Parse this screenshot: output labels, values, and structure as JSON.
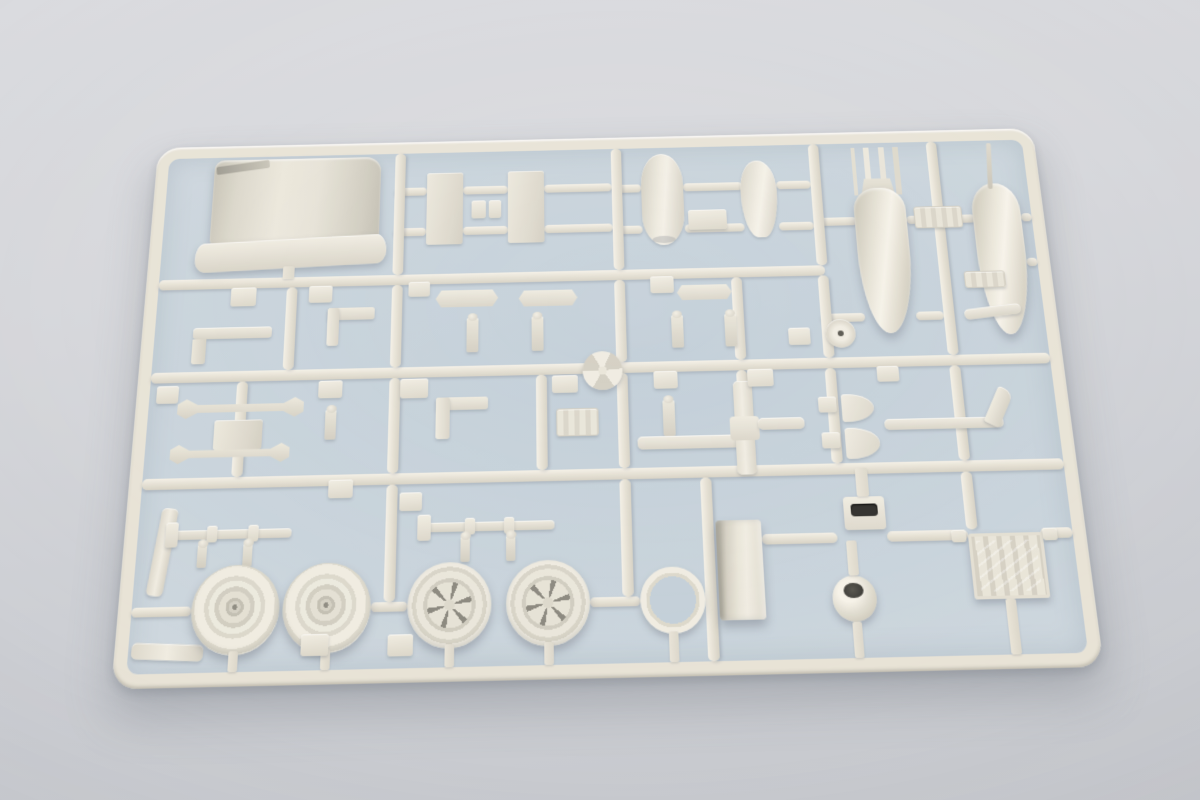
{
  "scene": {
    "description": "Photograph of a single off-white injection-molded plastic model kit sprue lying on a pale blue-gray surface, photographed at a slight angle",
    "background_color_top": "#dadbdf",
    "background_color_bottom": "#c6c8cd",
    "plastic_color": "#e8e3d6",
    "interior_tint": "#c6d2db",
    "shadow_color": "#5d626e"
  },
  "sprue": {
    "frame": {
      "width": 930,
      "height": 550,
      "thickness": 13,
      "corner_radius": 24
    },
    "runners": [
      {
        "x": 13,
        "y": 148,
        "w": 685,
        "h": 11
      },
      {
        "x": 13,
        "y": 246,
        "w": 904,
        "h": 11
      },
      {
        "x": 13,
        "y": 353,
        "w": 904,
        "h": 11
      },
      {
        "x": 253,
        "y": 52,
        "w": 34,
        "h": 9
      },
      {
        "x": 325,
        "y": 52,
        "w": 47,
        "h": 9
      },
      {
        "x": 410,
        "y": 52,
        "w": 71,
        "h": 9
      },
      {
        "x": 253,
        "y": 97,
        "w": 34,
        "h": 9
      },
      {
        "x": 325,
        "y": 97,
        "w": 47,
        "h": 9
      },
      {
        "x": 410,
        "y": 97,
        "w": 71,
        "h": 9
      },
      {
        "x": 481,
        "y": 54,
        "w": 31,
        "h": 9
      },
      {
        "x": 556,
        "y": 54,
        "w": 62,
        "h": 9
      },
      {
        "x": 654,
        "y": 54,
        "w": 36,
        "h": 9
      },
      {
        "x": 481,
        "y": 100,
        "w": 31,
        "h": 9
      },
      {
        "x": 556,
        "y": 100,
        "w": 62,
        "h": 9
      },
      {
        "x": 654,
        "y": 100,
        "w": 36,
        "h": 9
      },
      {
        "x": 690,
        "y": 96,
        "w": 45,
        "h": 9
      },
      {
        "x": 787,
        "y": 96,
        "w": 71,
        "h": 9
      },
      {
        "x": 906,
        "y": 96,
        "w": 11,
        "h": 9
      },
      {
        "x": 906,
        "y": 145,
        "w": 11,
        "h": 9
      },
      {
        "x": 690,
        "y": 200,
        "w": 45,
        "h": 9
      },
      {
        "x": 787,
        "y": 200,
        "w": 28,
        "h": 9
      },
      {
        "x": 617,
        "y": 420,
        "w": 73,
        "h": 10
      },
      {
        "x": 738,
        "y": 420,
        "w": 78,
        "h": 10
      },
      {
        "x": 886,
        "y": 420,
        "w": 31,
        "h": 10
      },
      {
        "x": 13,
        "y": 476,
        "w": 57,
        "h": 9
      },
      {
        "x": 241,
        "y": 476,
        "w": 35,
        "h": 9
      },
      {
        "x": 450,
        "y": 476,
        "w": 48,
        "h": 9
      },
      {
        "x": 253,
        "y": 13,
        "w": 11,
        "h": 135
      },
      {
        "x": 481,
        "y": 13,
        "w": 11,
        "h": 135
      },
      {
        "x": 690,
        "y": 13,
        "w": 11,
        "h": 135
      },
      {
        "x": 815,
        "y": 13,
        "w": 11,
        "h": 233
      },
      {
        "x": 145,
        "y": 159,
        "w": 11,
        "h": 87
      },
      {
        "x": 253,
        "y": 159,
        "w": 11,
        "h": 87
      },
      {
        "x": 481,
        "y": 159,
        "w": 11,
        "h": 87
      },
      {
        "x": 601,
        "y": 159,
        "w": 11,
        "h": 87
      },
      {
        "x": 690,
        "y": 159,
        "w": 11,
        "h": 87
      },
      {
        "x": 100,
        "y": 257,
        "w": 11,
        "h": 96
      },
      {
        "x": 253,
        "y": 257,
        "w": 11,
        "h": 96
      },
      {
        "x": 400,
        "y": 257,
        "w": 11,
        "h": 96
      },
      {
        "x": 481,
        "y": 257,
        "w": 11,
        "h": 96
      },
      {
        "x": 601,
        "y": 257,
        "w": 11,
        "h": 96
      },
      {
        "x": 690,
        "y": 257,
        "w": 11,
        "h": 96
      },
      {
        "x": 815,
        "y": 257,
        "w": 11,
        "h": 96
      },
      {
        "x": 253,
        "y": 364,
        "w": 11,
        "h": 112
      },
      {
        "x": 481,
        "y": 364,
        "w": 11,
        "h": 112
      },
      {
        "x": 560,
        "y": 364,
        "w": 11,
        "h": 173
      },
      {
        "x": 815,
        "y": 364,
        "w": 11,
        "h": 56
      }
    ],
    "parts": [
      {
        "n": "engine-cowling-panel",
        "s": "cowl-body",
        "x": 62,
        "y": 16,
        "w": 176,
        "h": 98
      },
      {
        "n": "cowling-lip",
        "s": "cowl-lip",
        "x": 48,
        "y": 106,
        "w": 198,
        "h": 32,
        "r": -2
      },
      {
        "n": "cowling-gate-stub",
        "s": "stub",
        "x": 140,
        "y": 136,
        "w": 12,
        "h": 14
      },
      {
        "n": "flat-panel-left",
        "s": "rect-panel",
        "x": 287,
        "y": 36,
        "w": 38,
        "h": 80
      },
      {
        "n": "flat-panel-right",
        "s": "rect-panel",
        "x": 372,
        "y": 36,
        "w": 38,
        "h": 80
      },
      {
        "n": "connector-block-a",
        "s": "sq",
        "x": 334,
        "y": 68,
        "w": 15,
        "h": 20
      },
      {
        "n": "connector-block-b",
        "s": "sq",
        "x": 352,
        "y": 68,
        "w": 13,
        "h": 20
      },
      {
        "n": "fuselage-spine",
        "s": "fuselage",
        "x": 512,
        "y": 20,
        "w": 44,
        "h": 102
      },
      {
        "n": "spine-block",
        "s": "sq",
        "x": 560,
        "y": 84,
        "w": 40,
        "h": 22
      },
      {
        "n": "tail-cone",
        "s": "teardrop",
        "x": 616,
        "y": 30,
        "w": 38,
        "h": 86
      },
      {
        "n": "bomb-tail-fins",
        "s": "fins4",
        "x": 735,
        "y": 18,
        "w": 50,
        "h": 54
      },
      {
        "n": "bomb-body",
        "s": "bomb",
        "x": 733,
        "y": 64,
        "w": 54,
        "h": 158
      },
      {
        "n": "drop-tank-body",
        "s": "tank",
        "x": 856,
        "y": 62,
        "w": 50,
        "h": 164
      },
      {
        "n": "pitot-antenna",
        "s": "antenna",
        "x": 877,
        "y": 16,
        "w": 5,
        "h": 52,
        "r": 4
      },
      {
        "n": "rack-bracket",
        "s": "bracket",
        "x": 795,
        "y": 86,
        "w": 50,
        "h": 24
      },
      {
        "n": "elbow-pipe-long",
        "s": "elbow",
        "x": 52,
        "y": 200,
        "w": 80,
        "h": 12
      },
      {
        "n": "fitting-sq-a",
        "s": "sq",
        "x": 88,
        "y": 158,
        "w": 26,
        "h": 20
      },
      {
        "n": "elbow-bracket",
        "s": "l-bracket",
        "x": 188,
        "y": 182,
        "w": 48,
        "h": 40
      },
      {
        "n": "fitting-sq-b",
        "s": "sq",
        "x": 168,
        "y": 158,
        "w": 24,
        "h": 18
      },
      {
        "n": "stabilizer-small-left",
        "s": "wing-sm",
        "x": 298,
        "y": 166,
        "w": 64,
        "h": 18
      },
      {
        "n": "fitting-sq-c",
        "s": "sq",
        "x": 270,
        "y": 156,
        "w": 22,
        "h": 16
      },
      {
        "n": "stabilizer-small-right",
        "s": "wing-sm",
        "x": 383,
        "y": 168,
        "w": 60,
        "h": 17
      },
      {
        "n": "knob-pin-a",
        "s": "pin",
        "x": 330,
        "y": 196,
        "w": 12,
        "h": 36
      },
      {
        "n": "knob-pin-b",
        "s": "pin",
        "x": 396,
        "y": 196,
        "w": 12,
        "h": 36
      },
      {
        "n": "fitting-sq-d",
        "s": "sq",
        "x": 518,
        "y": 156,
        "w": 24,
        "h": 18
      },
      {
        "n": "stabilizer-small-center",
        "s": "wing-sm",
        "x": 545,
        "y": 166,
        "w": 56,
        "h": 16
      },
      {
        "n": "knob-pin-c",
        "s": "pin",
        "x": 538,
        "y": 198,
        "w": 12,
        "h": 34
      },
      {
        "n": "knob-pin-d",
        "s": "pin",
        "x": 592,
        "y": 198,
        "w": 12,
        "h": 34
      },
      {
        "n": "wheel-hub-cap",
        "s": "screw-head",
        "x": 694,
        "y": 206,
        "w": 30,
        "h": 30
      },
      {
        "n": "fitting-sq-e",
        "s": "sq",
        "x": 656,
        "y": 214,
        "w": 22,
        "h": 18
      },
      {
        "n": "link-rod",
        "s": "arm-rod",
        "x": 836,
        "y": 196,
        "w": 58,
        "h": 11,
        "r": -6
      },
      {
        "n": "fitting-plate",
        "s": "bracket",
        "x": 840,
        "y": 158,
        "w": 42,
        "h": 18
      },
      {
        "n": "fitting-sq-f",
        "s": "sq",
        "x": 20,
        "y": 260,
        "w": 22,
        "h": 18
      },
      {
        "n": "tail-plane-upper",
        "s": "stab-wing",
        "x": 42,
        "y": 274,
        "w": 126,
        "h": 20
      },
      {
        "n": "frame-box",
        "s": "rect-panel",
        "x": 80,
        "y": 296,
        "w": 48,
        "h": 30
      },
      {
        "n": "tail-plane-lower",
        "s": "stab-wing",
        "x": 38,
        "y": 320,
        "w": 118,
        "h": 19
      },
      {
        "n": "knob-pin-e",
        "s": "pin",
        "x": 190,
        "y": 288,
        "w": 11,
        "h": 30
      },
      {
        "n": "fitting-sq-g",
        "s": "sq",
        "x": 182,
        "y": 258,
        "w": 24,
        "h": 18
      },
      {
        "n": "bracket-l",
        "s": "l-bracket",
        "x": 300,
        "y": 278,
        "w": 52,
        "h": 42
      },
      {
        "n": "fitting-sq-h",
        "s": "sq",
        "x": 264,
        "y": 258,
        "w": 28,
        "h": 20
      },
      {
        "n": "bracket-b",
        "s": "bracket",
        "x": 420,
        "y": 292,
        "w": 42,
        "h": 28
      },
      {
        "n": "fitting-sq-i",
        "s": "sq",
        "x": 416,
        "y": 258,
        "w": 26,
        "h": 18
      },
      {
        "n": "spinner-backplate",
        "s": "spiral",
        "x": 447,
        "y": 234,
        "w": 40,
        "h": 40
      },
      {
        "n": "fitting-sq-j",
        "s": "sq",
        "x": 518,
        "y": 256,
        "w": 24,
        "h": 18
      },
      {
        "n": "knob-pin-f",
        "s": "pin",
        "x": 526,
        "y": 286,
        "w": 12,
        "h": 36
      },
      {
        "n": "wing-spar-long",
        "s": "arm-rod",
        "x": 500,
        "y": 322,
        "w": 102,
        "h": 13
      },
      {
        "n": "spar-upright",
        "s": "vert-cross",
        "x": 597,
        "y": 268,
        "w": 19,
        "h": 94
      },
      {
        "n": "wing-spar-short",
        "s": "arm-rod",
        "x": 620,
        "y": 306,
        "w": 46,
        "h": 12
      },
      {
        "n": "fitting-sq-k",
        "s": "sq",
        "x": 612,
        "y": 256,
        "w": 26,
        "h": 18
      },
      {
        "n": "half-disc-upper",
        "s": "d-part",
        "x": 704,
        "y": 284,
        "w": 32,
        "h": 28
      },
      {
        "n": "half-disc-lower",
        "s": "d-part",
        "x": 705,
        "y": 318,
        "w": 34,
        "h": 31
      },
      {
        "n": "fitting-sq-l",
        "s": "sq",
        "x": 681,
        "y": 286,
        "w": 18,
        "h": 16
      },
      {
        "n": "fitting-sq-m",
        "s": "sq",
        "x": 682,
        "y": 322,
        "w": 18,
        "h": 16
      },
      {
        "n": "gear-leg-arm",
        "s": "arm-rod",
        "x": 745,
        "y": 310,
        "w": 118,
        "h": 11
      },
      {
        "n": "gear-leg-tip",
        "s": "arm-tip",
        "x": 852,
        "y": 280,
        "w": 16,
        "h": 40,
        "r": 28
      },
      {
        "n": "fitting-sq-n",
        "s": "sq",
        "x": 742,
        "y": 256,
        "w": 22,
        "h": 16
      },
      {
        "n": "wing-strip",
        "s": "strip",
        "x": 30,
        "y": 382,
        "w": 16,
        "h": 84,
        "r": 7
      },
      {
        "n": "edge-strip",
        "s": "strip",
        "x": 16,
        "y": 510,
        "w": 68,
        "h": 15,
        "r": 3
      },
      {
        "n": "axle-rod-left",
        "s": "axle",
        "x": 48,
        "y": 404,
        "w": 114,
        "h": 9
      },
      {
        "n": "axle-fork-left",
        "s": "sq",
        "x": 40,
        "y": 396,
        "w": 12,
        "h": 24
      },
      {
        "n": "axle-collar-a",
        "s": "sq",
        "x": 80,
        "y": 400,
        "w": 10,
        "h": 16
      },
      {
        "n": "axle-collar-b",
        "s": "sq",
        "x": 120,
        "y": 400,
        "w": 10,
        "h": 16
      },
      {
        "n": "axle-pin-a",
        "s": "pin",
        "x": 72,
        "y": 418,
        "w": 9,
        "h": 22
      },
      {
        "n": "axle-pin-b",
        "s": "pin",
        "x": 116,
        "y": 418,
        "w": 9,
        "h": 22
      },
      {
        "n": "axle-rod-right",
        "s": "axle",
        "x": 293,
        "y": 402,
        "w": 124,
        "h": 9
      },
      {
        "n": "axle-fork-right",
        "s": "sq",
        "x": 284,
        "y": 394,
        "w": 13,
        "h": 25
      },
      {
        "n": "axle-collar-c",
        "s": "sq",
        "x": 330,
        "y": 398,
        "w": 10,
        "h": 16
      },
      {
        "n": "axle-collar-d",
        "s": "sq",
        "x": 368,
        "y": 398,
        "w": 10,
        "h": 16
      },
      {
        "n": "axle-pin-c",
        "s": "pin",
        "x": 326,
        "y": 416,
        "w": 9,
        "h": 24
      },
      {
        "n": "axle-pin-d",
        "s": "pin",
        "x": 370,
        "y": 416,
        "w": 9,
        "h": 24
      },
      {
        "n": "fitting-sq-o",
        "s": "sq",
        "x": 196,
        "y": 358,
        "w": 24,
        "h": 18
      },
      {
        "n": "fitting-sq-p",
        "s": "sq",
        "x": 266,
        "y": 372,
        "w": 22,
        "h": 18
      },
      {
        "n": "main-wheel-left",
        "s": "wheel-disc",
        "x": 70,
        "y": 438,
        "w": 84,
        "h": 84
      },
      {
        "n": "main-wheel-right",
        "s": "wheel-disc",
        "x": 157,
        "y": 438,
        "w": 84,
        "h": 84
      },
      {
        "n": "spoked-hub-left",
        "s": "wheel-spoked",
        "x": 276,
        "y": 440,
        "w": 80,
        "h": 80
      },
      {
        "n": "spoked-hub-right",
        "s": "wheel-spoked",
        "x": 370,
        "y": 440,
        "w": 80,
        "h": 80
      },
      {
        "n": "cowl-ring",
        "s": "ring",
        "x": 498,
        "y": 449,
        "w": 62,
        "h": 62
      },
      {
        "n": "wheel-stem-a",
        "s": "stub",
        "x": 108,
        "y": 518,
        "w": 9,
        "h": 19
      },
      {
        "n": "wheel-stem-b",
        "s": "stub",
        "x": 195,
        "y": 518,
        "w": 9,
        "h": 19
      },
      {
        "n": "wheel-stem-c",
        "s": "stub",
        "x": 312,
        "y": 516,
        "w": 9,
        "h": 21
      },
      {
        "n": "wheel-stem-d",
        "s": "stub",
        "x": 406,
        "y": 516,
        "w": 9,
        "h": 21
      },
      {
        "n": "ring-stem",
        "s": "stub",
        "x": 524,
        "y": 509,
        "w": 9,
        "h": 28
      },
      {
        "n": "stem-block-a",
        "s": "sq",
        "x": 176,
        "y": 504,
        "w": 26,
        "h": 20
      },
      {
        "n": "stem-block-b",
        "s": "sq",
        "x": 258,
        "y": 506,
        "w": 24,
        "h": 20
      },
      {
        "n": "intake-box",
        "s": "box-deep",
        "x": 573,
        "y": 406,
        "w": 44,
        "h": 94
      },
      {
        "n": "slot-box",
        "s": "slot-box",
        "x": 698,
        "y": 386,
        "w": 40,
        "h": 32
      },
      {
        "n": "slot-box-stub",
        "s": "stub",
        "x": 712,
        "y": 358,
        "w": 12,
        "h": 28
      },
      {
        "n": "control-ball",
        "s": "ball",
        "x": 681,
        "y": 461,
        "w": 42,
        "h": 43
      },
      {
        "n": "ball-stub",
        "s": "stub",
        "x": 698,
        "y": 428,
        "w": 10,
        "h": 33
      },
      {
        "n": "ball-stem",
        "s": "stub",
        "x": 698,
        "y": 504,
        "w": 9,
        "h": 33
      },
      {
        "n": "radiator-grille",
        "s": "grille",
        "x": 816,
        "y": 424,
        "w": 72,
        "h": 62
      },
      {
        "n": "grille-stem",
        "s": "stub",
        "x": 845,
        "y": 486,
        "w": 10,
        "h": 51
      },
      {
        "n": "grille-pin-left",
        "s": "sq",
        "x": 800,
        "y": 420,
        "w": 14,
        "h": 12
      },
      {
        "n": "grille-pin-right",
        "s": "sq",
        "x": 888,
        "y": 420,
        "w": 14,
        "h": 12
      }
    ]
  }
}
